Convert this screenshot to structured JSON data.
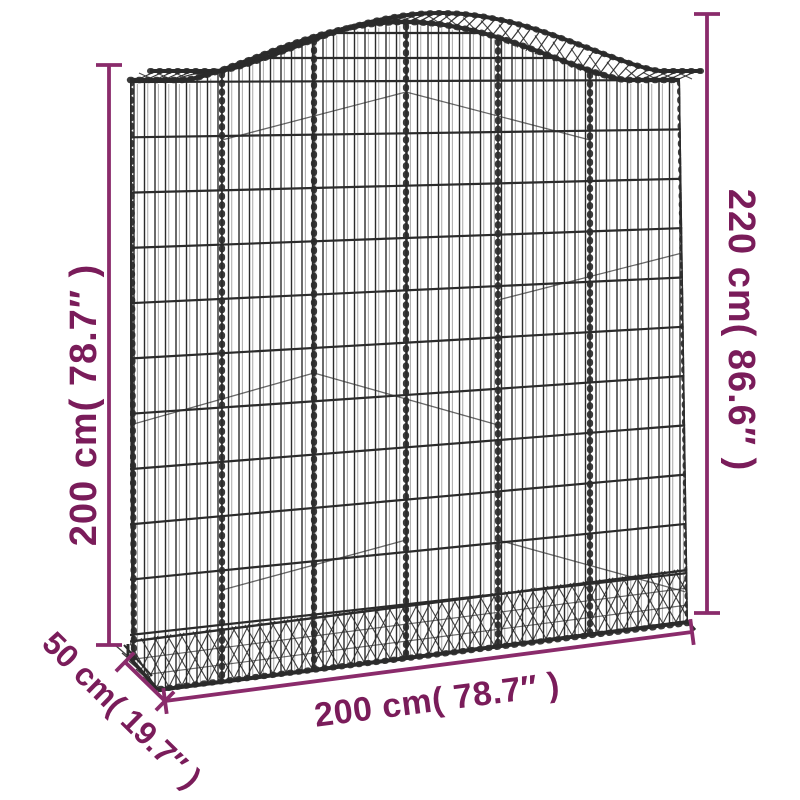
{
  "colors": {
    "background": "#ffffff",
    "dimension_line": "#8A2B6B",
    "dimension_text": "#7A1C5A",
    "wire": "#2b2b2b"
  },
  "dimensions": {
    "side_height": {
      "label": "200 cm( 78.7″ )",
      "value_cm": 200,
      "value_inch": 78.7
    },
    "total_height": {
      "label": "220 cm( 86.6″ )",
      "value_cm": 220,
      "value_inch": 86.6
    },
    "width": {
      "label": "200 cm( 78.7″ )",
      "value_cm": 200,
      "value_inch": 78.7
    },
    "depth": {
      "label": "50 cm( 19.7″ )",
      "value_cm": 50,
      "value_inch": 19.7
    }
  },
  "illustration": {
    "name": "arched-gabion-wire-mesh-basket"
  }
}
